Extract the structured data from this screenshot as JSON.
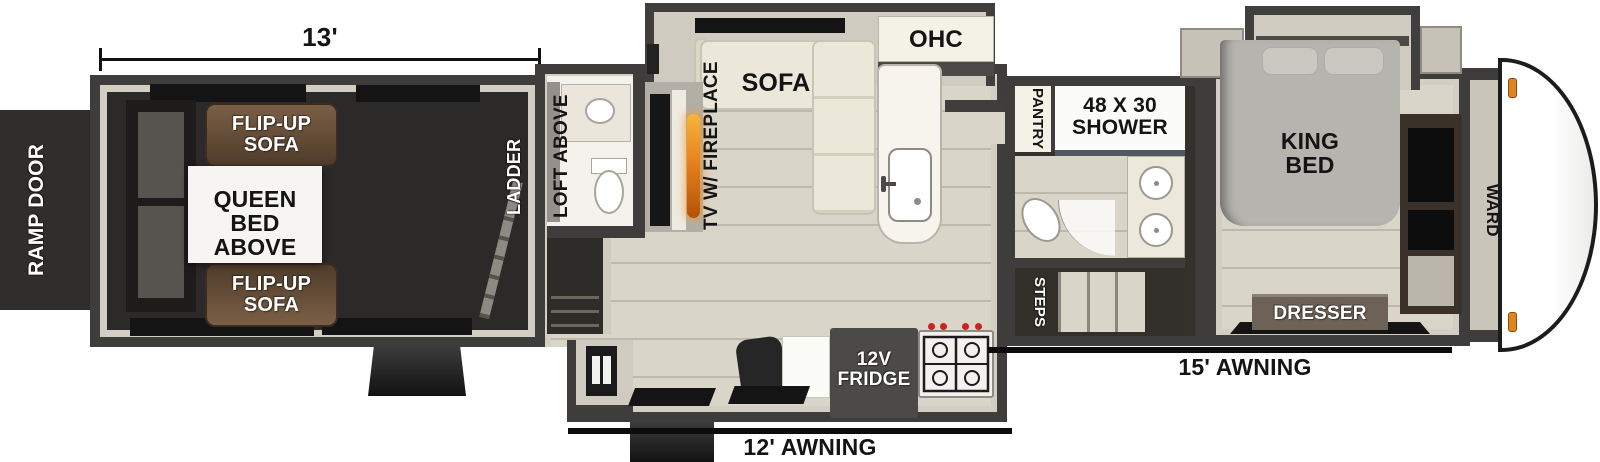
{
  "garage": {
    "dimension": "13'",
    "ramp_door": "RAMP DOOR",
    "flip_up_sofa": "FLIP-UP SOFA",
    "queen_bed": "QUEEN BED ABOVE",
    "ladder": "LADDER"
  },
  "living": {
    "loft": "LOFT ABOVE",
    "tv_fireplace": "TV W/ FIREPLACE",
    "sofa": "SOFA",
    "ohc": "OHC",
    "fridge": "12V FRIDGE",
    "awning": "12' AWNING"
  },
  "bath": {
    "pantry": "PANTRY",
    "shower": "48 X 30 SHOWER",
    "steps": "STEPS"
  },
  "bedroom": {
    "king_bed": "KING BED",
    "dresser": "DRESSER",
    "ward": "WARD",
    "awning": "15' AWNING"
  },
  "colors": {
    "wall": "#3e3d3b",
    "lining": "#d2cec3",
    "floor_light": "#d9d5c9",
    "floor_dark": "#2b2a28",
    "sofa_brown": "#6a523c",
    "flame_accent": "#e8821e",
    "marker_light": "#e08420"
  }
}
